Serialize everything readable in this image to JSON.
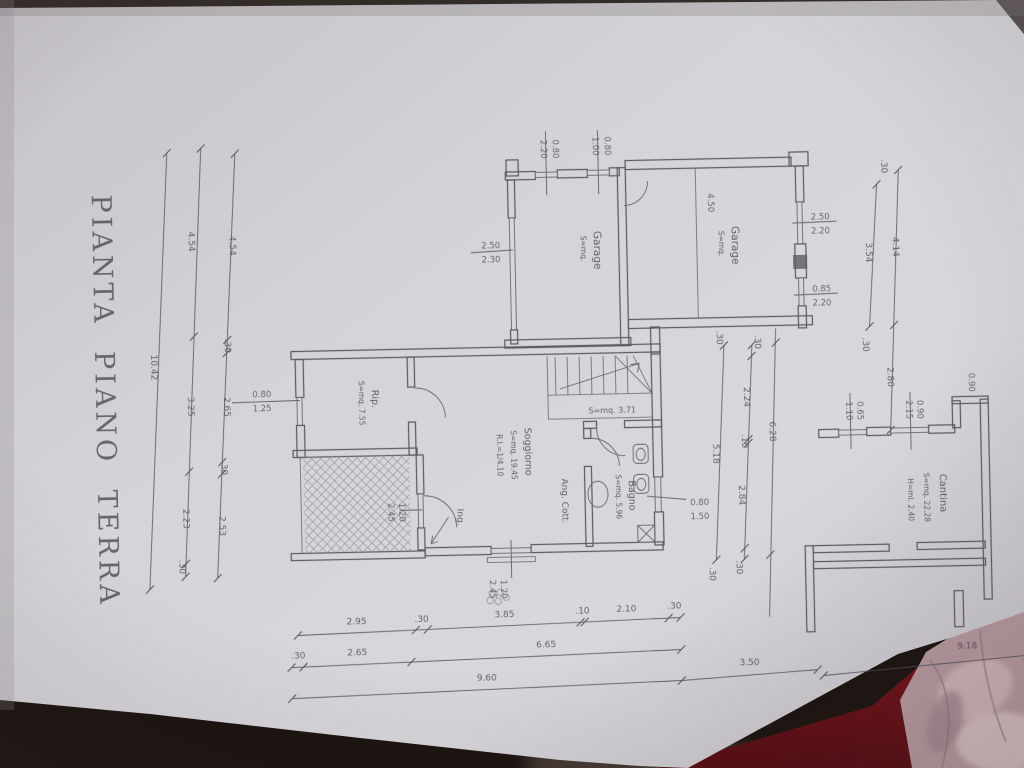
{
  "title": "PIANTA PIANO TERRA",
  "rooms": {
    "garage_left": {
      "name": "Garage",
      "area": "S=mq."
    },
    "garage_right": {
      "name": "Garage",
      "area": "S=mq."
    },
    "rip": {
      "name": "Rip.",
      "area": "S=mq. 7.55"
    },
    "soggiorno": {
      "name": "Soggiorno",
      "area": "S=mq. 19.45",
      "ratio": "R.I.=1/4.10"
    },
    "ang_cott": {
      "name": "Ang. Cott."
    },
    "bagno": {
      "name": "Bagno",
      "area": "S=mq. 5.96"
    },
    "disimpegno": {
      "area": "S=mq. 3.71"
    },
    "cantina": {
      "name": "Cantina",
      "area": "S=mq. 22.28",
      "height": "H=ml. 2.40"
    },
    "ingresso": {
      "name": "Ing."
    }
  },
  "openings": {
    "garage_back_door1": [
      "0.80",
      "2.20"
    ],
    "garage_back_door2": [
      "0.80",
      "1.00"
    ],
    "garage_left_window": [
      "2.50",
      "2.30"
    ],
    "garage_right_window1": [
      "2.50",
      "2.20"
    ],
    "garage_right_window2": [
      "0.85",
      "2.20"
    ],
    "garage_door": "4.50",
    "cantina_window1": [
      "0.65",
      "1.10"
    ],
    "cantina_window2": [
      "0.90",
      "2.15"
    ],
    "cantina_step": "0.90",
    "rip_window": [
      "0.80",
      "1.25"
    ],
    "bagno_window": [
      "0.80",
      "1.50"
    ],
    "entrance_door": [
      "1.20",
      "2.45"
    ],
    "porch_door": [
      "1.20",
      "2.45"
    ]
  },
  "dimensions": {
    "left_inner": [
      "4.54",
      ".30",
      "2.65",
      ".30",
      "2.53"
    ],
    "left_middle": [
      "4.54",
      "3.25",
      "2.23",
      ".30"
    ],
    "left_total": "10.42",
    "top_a": [
      ".30",
      "3.54",
      ".30"
    ],
    "top_b": [
      "4.14",
      "2.80"
    ],
    "right_a": [
      ".30",
      "5.18",
      ".30"
    ],
    "right_b": [
      ".30",
      "2.24",
      ".10",
      "2.84",
      ".30"
    ],
    "right_total": "6.28",
    "bottom_a": [
      "2.95",
      ".30",
      "3.85",
      ".10",
      "2.10",
      ".30"
    ],
    "bottom_b": [
      ".30",
      "2.65",
      "6.65"
    ],
    "bottom_c": [
      "9.60",
      "3.50"
    ],
    "bottom_total": "9.18"
  }
}
